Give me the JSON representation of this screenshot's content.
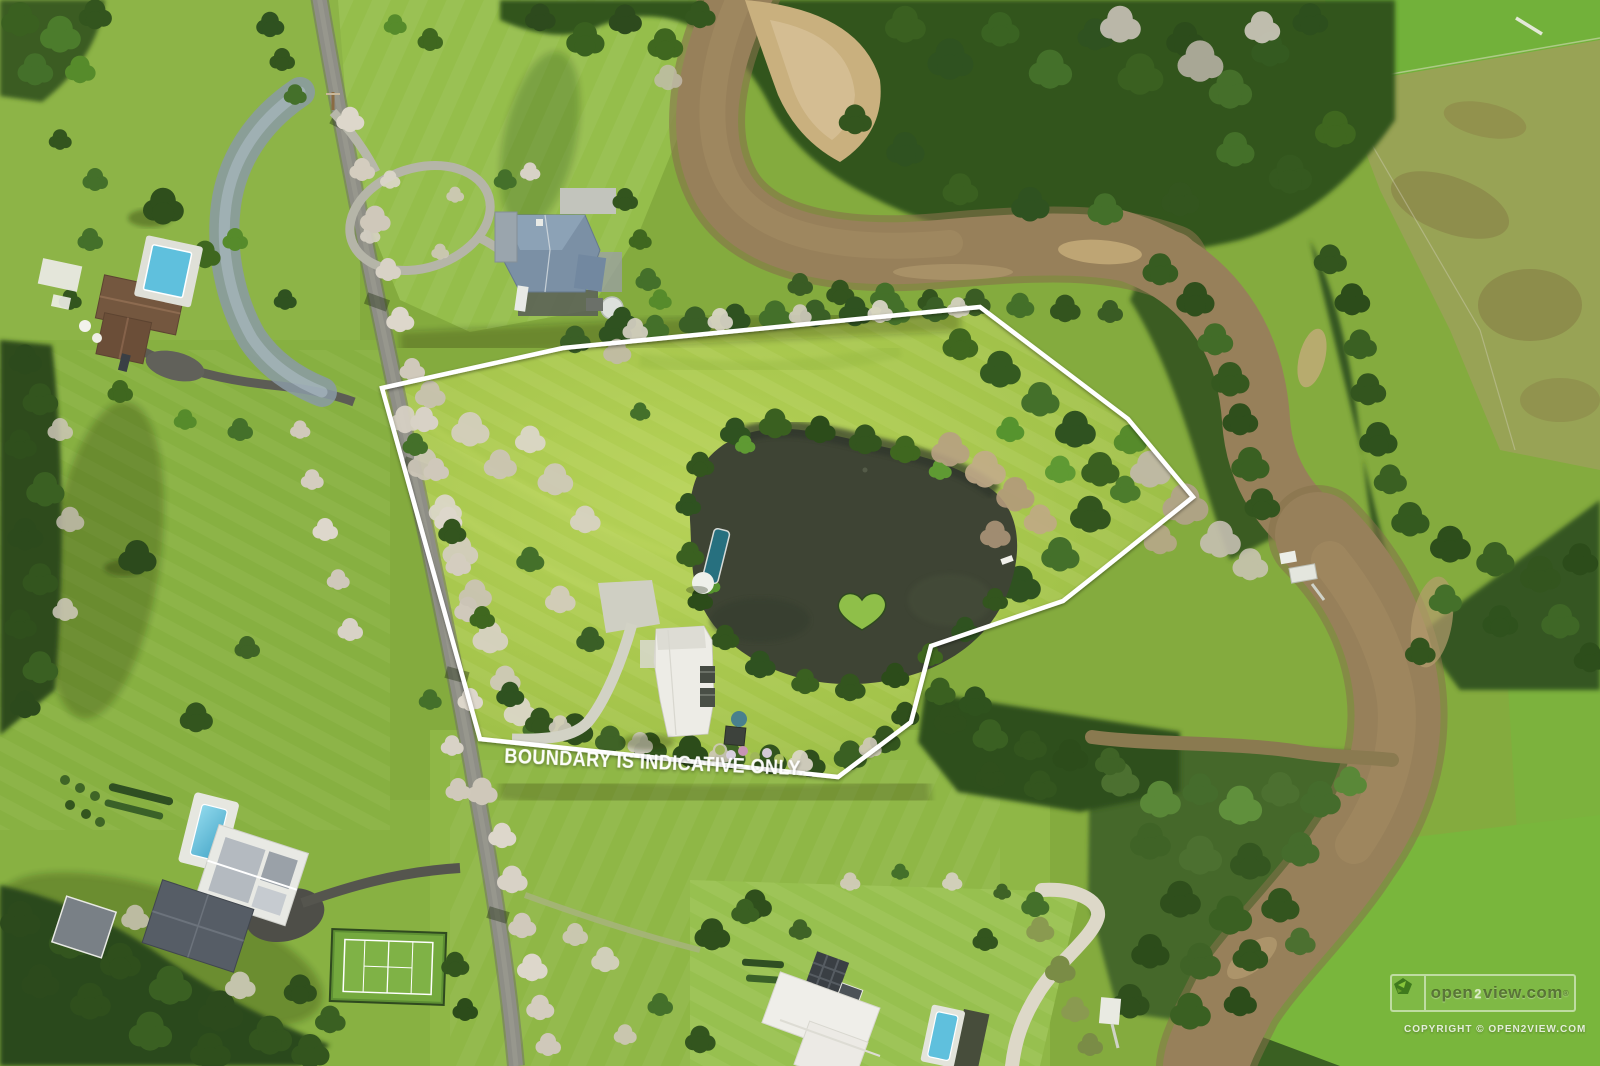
{
  "overlay": {
    "boundary_note": "BOUNDARY IS INDICATIVE ONLY."
  },
  "boundary": {
    "points_svg": "382,388 563,348 980,307 1128,419 1193,497 1097,574 1063,601 931,646 911,722 838,777 480,739"
  },
  "watermark": {
    "logo_icon": "open2view-leaf-logo",
    "open": "open",
    "two": "2",
    "view_com": "view.com",
    "registered": "®",
    "copyright": "COPYRIGHT ©  OPEN2VIEW.COM"
  },
  "colors": {
    "boundary_line": "#ffffff",
    "river_water": "#97805a",
    "pond_water": "#3e4434",
    "road_asphalt": "#8e8e86",
    "pool_water": "#5fc0dd",
    "tennis_court": "#7fb246",
    "sand_bank": "#c9b07e",
    "lawn_bright": "#a6c54d",
    "bush_dark": "#2f4f1c",
    "blossom_tree": "#d8d2c6"
  }
}
